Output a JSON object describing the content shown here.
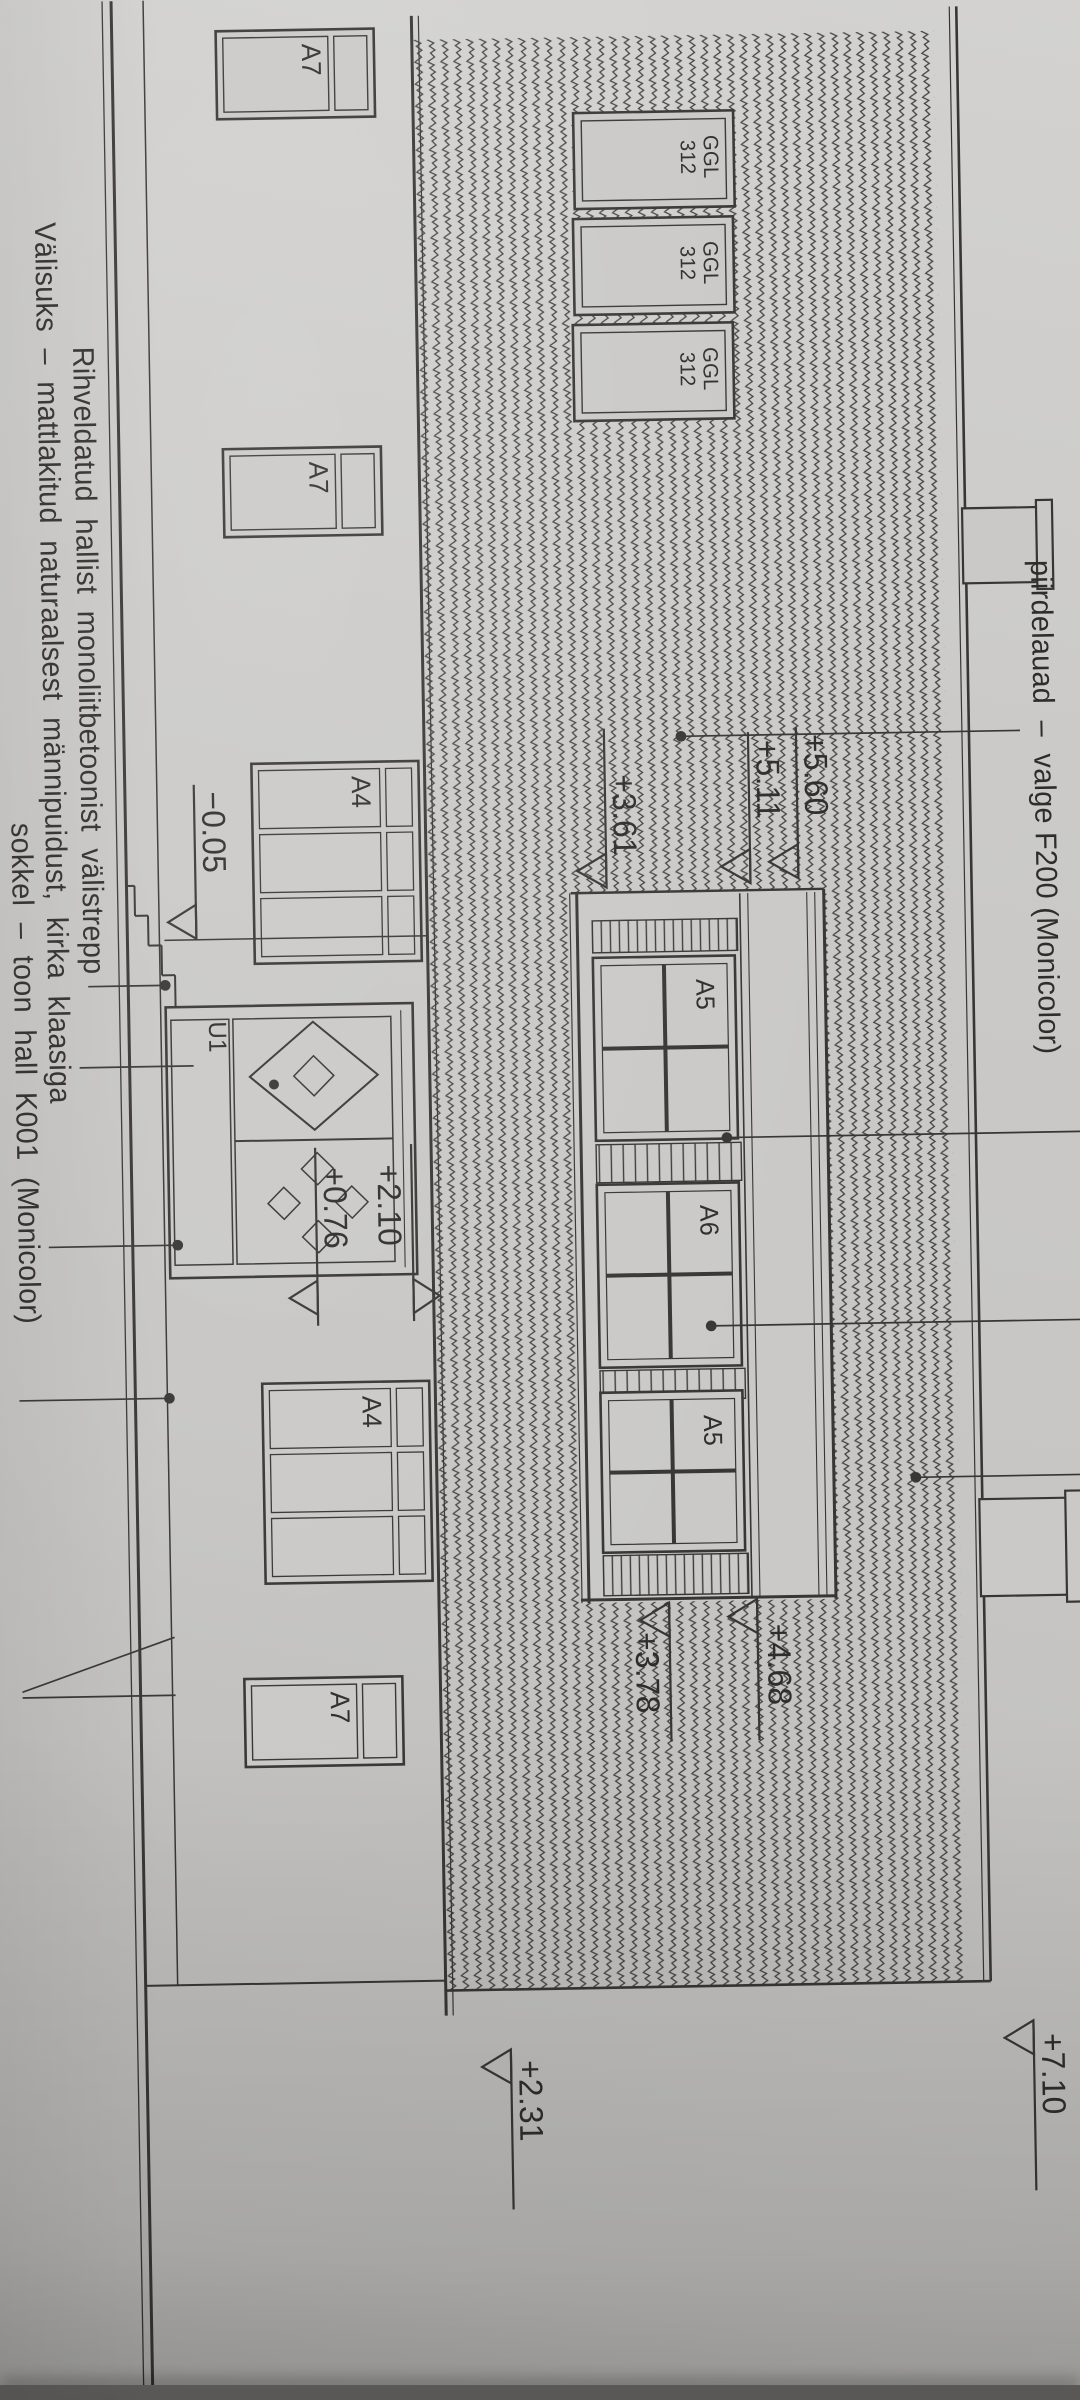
{
  "drawing": {
    "type_note": "architectural elevation photo, rotated 90°",
    "paper_color": "#cac9c7",
    "line_color": "#383634"
  },
  "fascia_note": {
    "text": "piirdelauad  –  valge F200 (Monicolor)"
  },
  "notes": [
    {
      "text": "Rihveldatud  hallist  monoliitbetoonist  välistrepp"
    },
    {
      "text": "Välisuks  –  mattlakitud  naturaalsest  männipuidust,  kirka  klaasiga"
    },
    {
      "text": "sokkel  –  toon  hall  K001  (Monicolor)"
    }
  ],
  "elevation_marks": [
    {
      "id": "ridge",
      "value": "+7.10"
    },
    {
      "id": "right-eave",
      "value": "+2.31"
    },
    {
      "id": "dormer-top-left",
      "value": "+5.60"
    },
    {
      "id": "dormer-eave-left",
      "value": "+5.11"
    },
    {
      "id": "dormer-sill-left",
      "value": "+3.61"
    },
    {
      "id": "dormer-top-right",
      "value": "+4.68"
    },
    {
      "id": "dormer-sill-right",
      "value": "+3.78"
    },
    {
      "id": "door-head",
      "value": "+2.10"
    },
    {
      "id": "landing",
      "value": "+0.76"
    },
    {
      "id": "ground",
      "value": "−0.05"
    }
  ],
  "window_labels": {
    "a7": "A7",
    "a4": "A4",
    "a5": "A5",
    "a6": "A6",
    "door": "U1",
    "roof_window_line1": "GGL",
    "roof_window_line2": "312"
  }
}
